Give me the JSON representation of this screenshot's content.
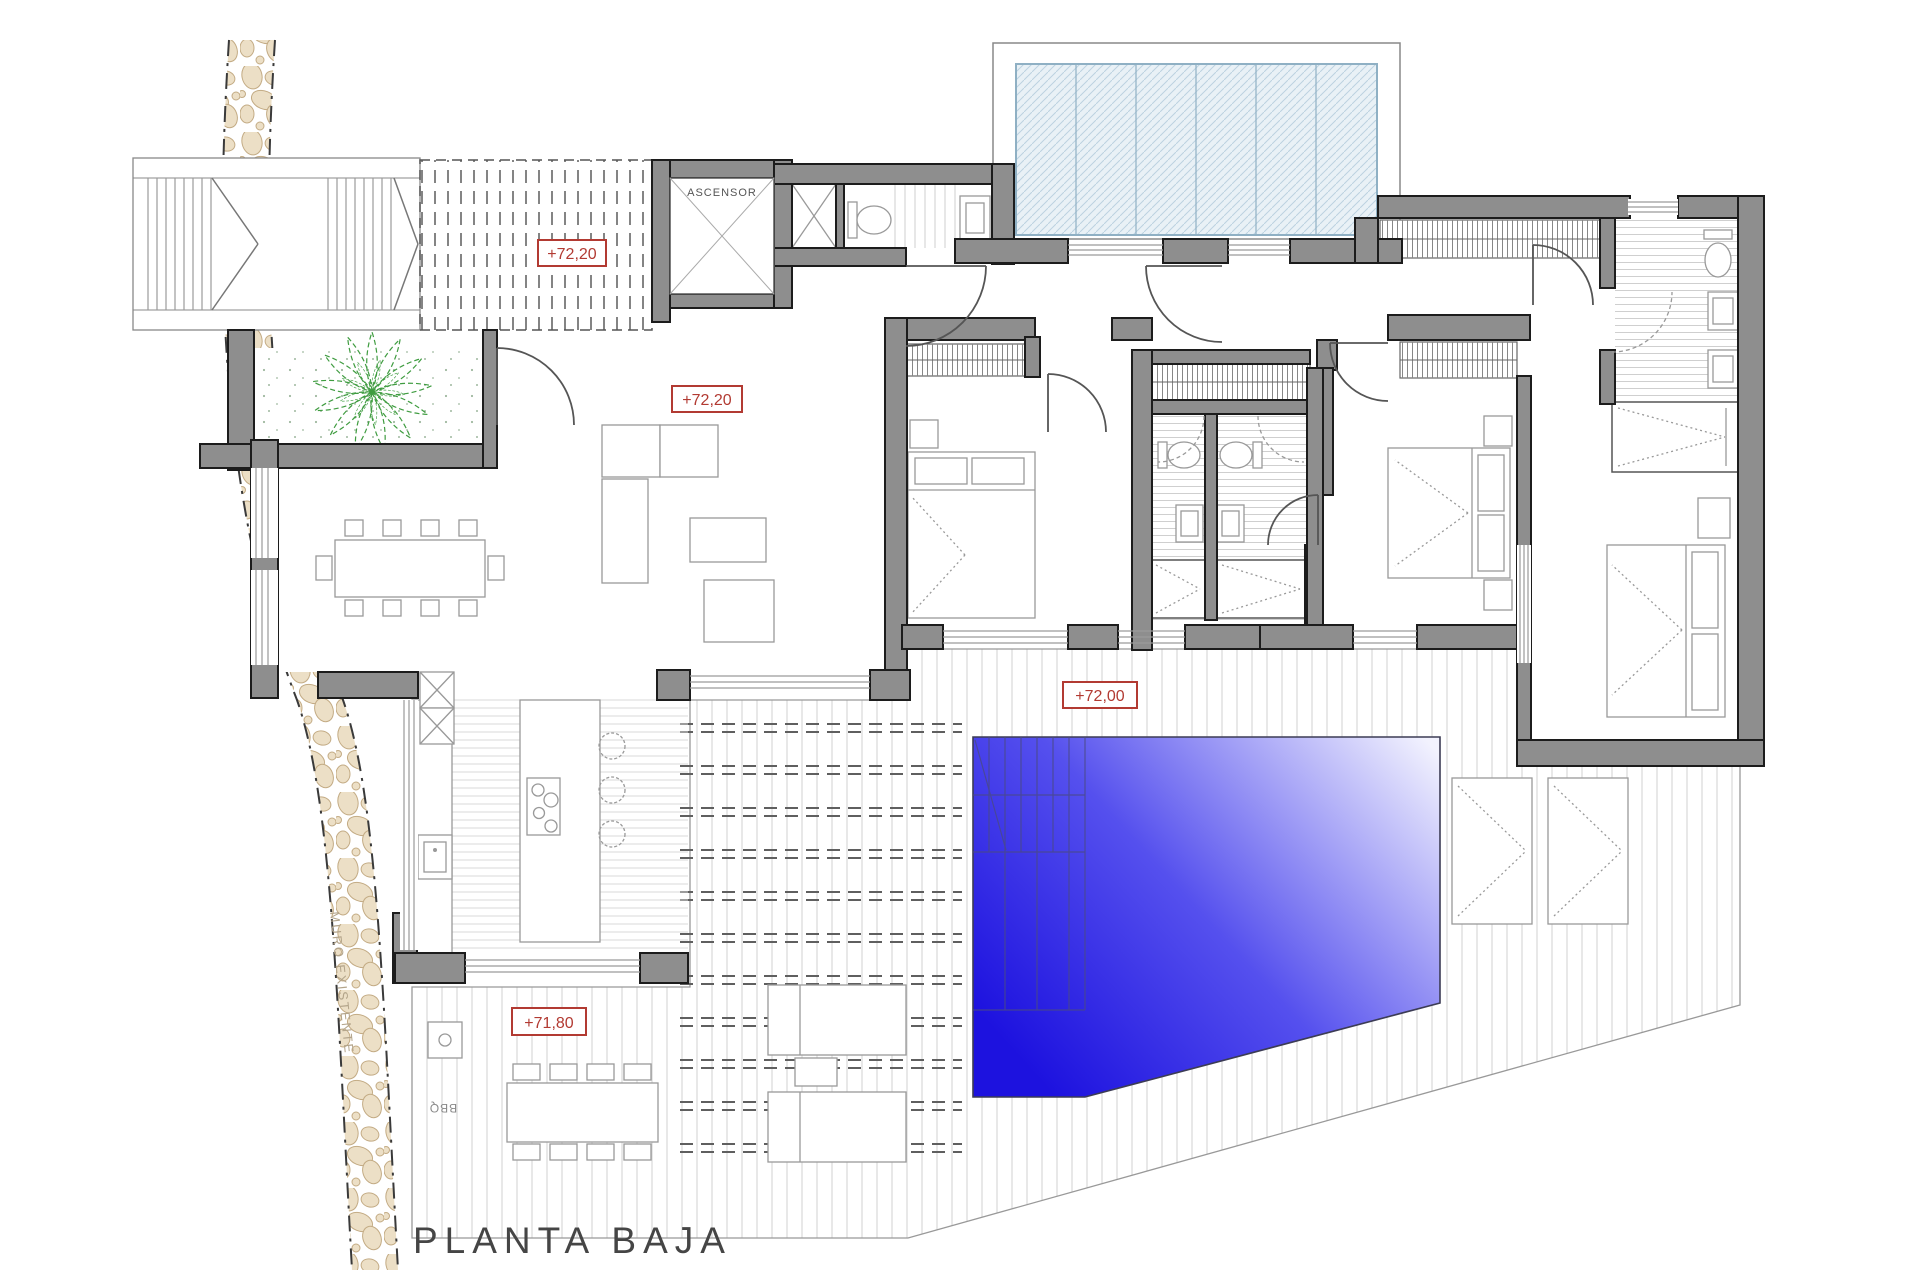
{
  "title": "PLANTA BAJA",
  "labels": {
    "elevator": "ASCENSOR",
    "barbecue": "BBQ",
    "existing_wall": "MURO EXISTENTE"
  },
  "elevations": {
    "entry_terrace": "+72,20",
    "living_room": "+72,20",
    "pool_deck": "+72,00",
    "bbq_terrace": "+71,80"
  },
  "colors": {
    "wall_fill": "#8e8e8e",
    "wall_outline": "#1c1c1c",
    "elevation_red": "#b23a32",
    "pool_deep_blue": "#1d12df",
    "pool_mid_blue": "#5550ee",
    "pool_light": "#f2f2fe",
    "glass_fill": "#e9f1f6",
    "glass_frame": "#8fb0c4",
    "plant_green": "#3f9c40",
    "stone_fill": "#ecdfc6",
    "stone_outline": "#c3ab84",
    "furniture_line": "#999999",
    "deck_line": "#d0d0d0",
    "title_color": "#454545"
  }
}
